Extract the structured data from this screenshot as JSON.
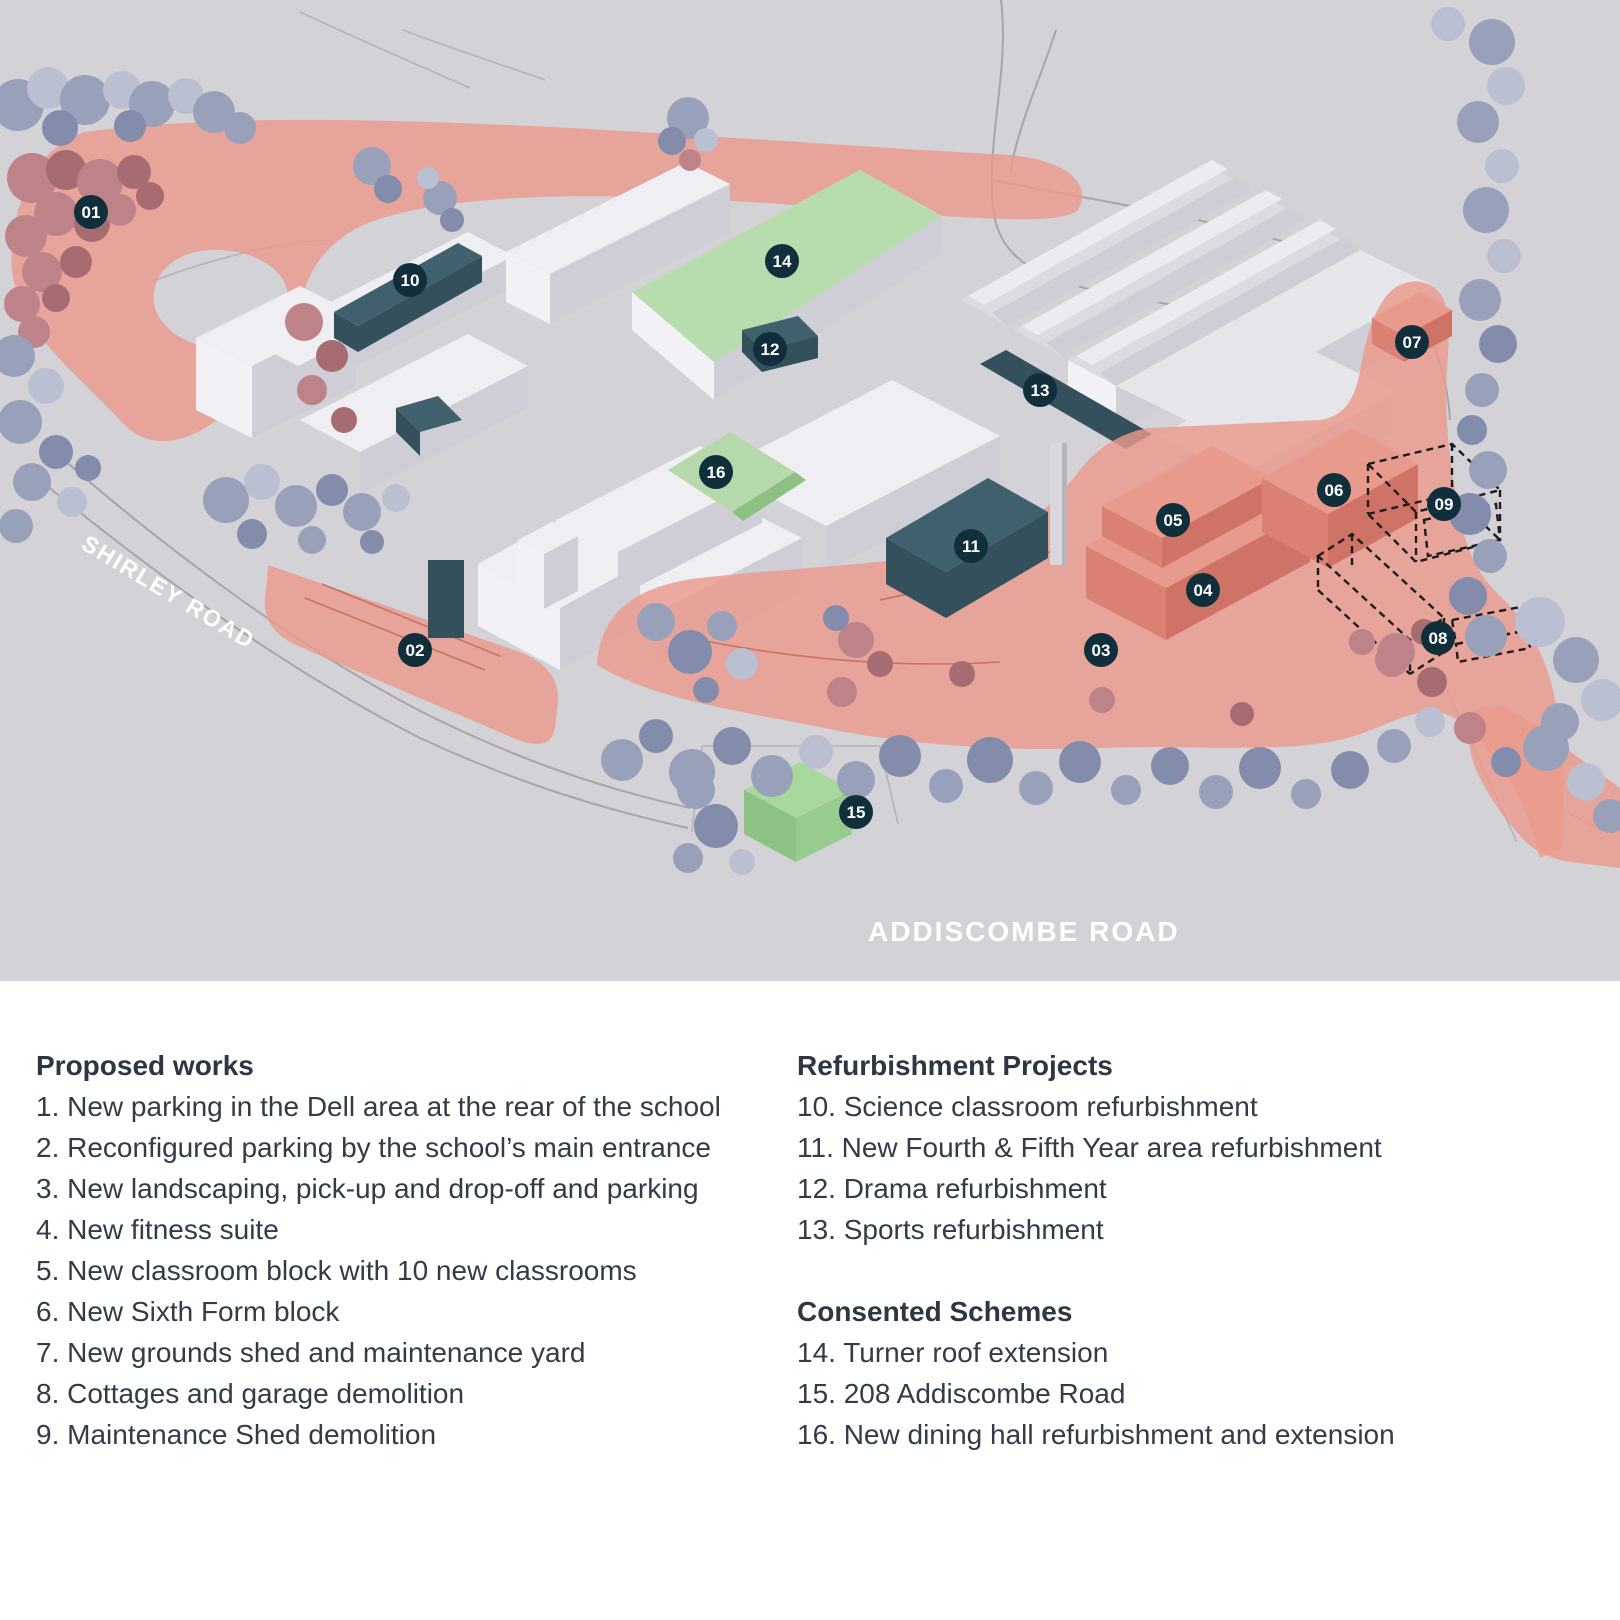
{
  "map": {
    "road_labels": {
      "shirley": "SHIRLEY ROAD",
      "addiscombe": "ADDISCOMBE ROAD"
    },
    "markers": [
      {
        "label": "01"
      },
      {
        "label": "02"
      },
      {
        "label": "03"
      },
      {
        "label": "04"
      },
      {
        "label": "05"
      },
      {
        "label": "06"
      },
      {
        "label": "07"
      },
      {
        "label": "08"
      },
      {
        "label": "09"
      },
      {
        "label": "10"
      },
      {
        "label": "11"
      },
      {
        "label": "12"
      },
      {
        "label": "13"
      },
      {
        "label": "14"
      },
      {
        "label": "15"
      },
      {
        "label": "16"
      }
    ],
    "legend_colors": {
      "proposed_works_overlay": "#EA9A8C",
      "refurbishment_projects": "#3F5D6B",
      "consented_schemes": "#B7DCAE",
      "marker_background": "#102F3B",
      "map_background": "#D3D2D7"
    }
  },
  "legend": {
    "proposed_works": {
      "title": "Proposed works",
      "items": [
        "1. New parking in the Dell area at the rear of the school",
        "2. Reconfigured parking by the school’s main entrance",
        "3. New landscaping, pick-up and drop-off and parking",
        "4. New fitness suite",
        "5. New classroom block with 10 new classrooms",
        "6. New Sixth Form block",
        "7. New grounds shed and maintenance yard",
        "8. Cottages and garage demolition",
        "9. Maintenance Shed demolition"
      ]
    },
    "refurbishment_projects": {
      "title": "Refurbishment Projects",
      "items": [
        "10. Science classroom refurbishment",
        "11. New Fourth & Fifth Year area refurbishment",
        "12. Drama refurbishment",
        "13. Sports refurbishment"
      ]
    },
    "consented_schemes": {
      "title": "Consented Schemes",
      "items": [
        "14. Turner roof extension",
        "15. 208 Addiscombe Road",
        "16. New dining hall refurbishment and extension"
      ]
    }
  }
}
